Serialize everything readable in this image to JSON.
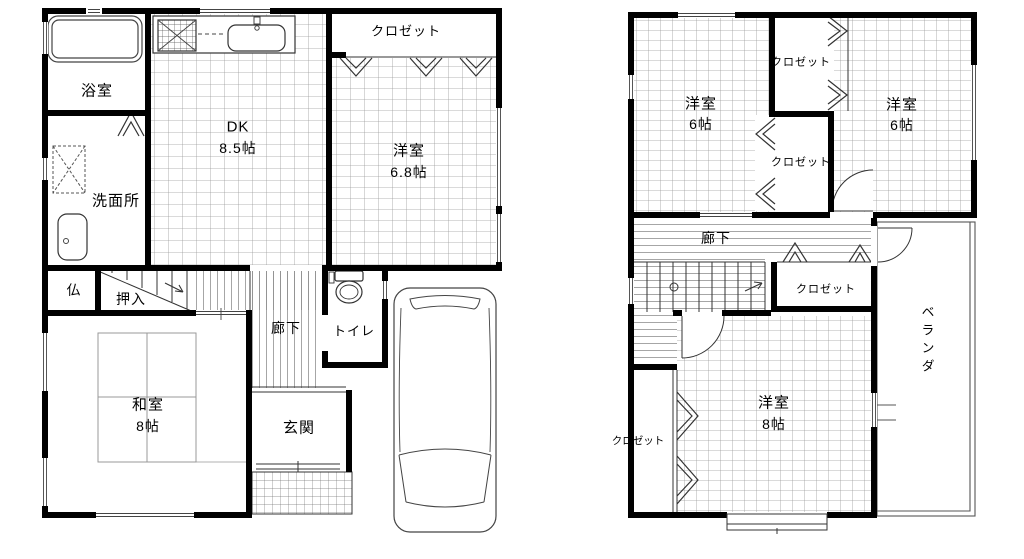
{
  "floor1": {
    "bath": "浴室",
    "washroom": "洗面所",
    "dk_name": "DK",
    "dk_size": "8.5帖",
    "closet": "クロゼット",
    "west_name": "洋室",
    "west_size": "6.8帖",
    "butsudan": "仏",
    "oshiire": "押入",
    "hallway": "廊下",
    "toilet": "トイレ",
    "washitsu_name": "和室",
    "washitsu_size": "8帖",
    "entrance": "玄関"
  },
  "floor2": {
    "room_nw_name": "洋室",
    "room_nw_size": "6帖",
    "room_ne_name": "洋室",
    "room_ne_size": "6帖",
    "closet_top": "クロゼット",
    "closet_mid": "クロゼット",
    "hallway": "廊下",
    "closet_hall": "クロゼット",
    "veranda": "ベランダ",
    "room_s_name": "洋室",
    "room_s_size": "8帖",
    "closet_sw": "クロゼット"
  },
  "colors": {
    "background": "#ffffff",
    "wall": "#000000",
    "thin_line": "#333333",
    "hatch": "#9b9b9b",
    "fixture": "#444444"
  }
}
